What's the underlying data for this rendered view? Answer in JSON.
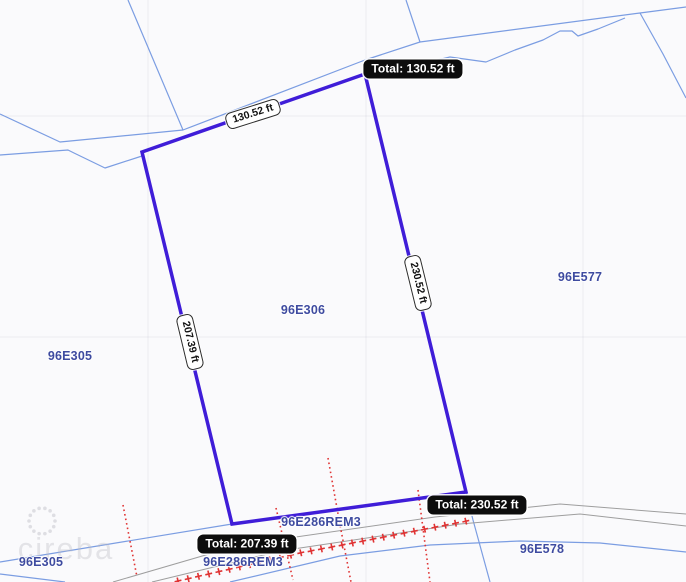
{
  "map": {
    "background": "#fafafc",
    "watermark": {
      "text": "cireba",
      "x": 66,
      "y": 549,
      "color": "rgba(188,188,198,0.38)",
      "logo": {
        "cx": 42,
        "cy": 521,
        "r": 13,
        "dots": 14,
        "dot_r": 1.8,
        "color": "rgba(188,188,198,0.45)"
      }
    },
    "section_lines": {
      "color": "rgba(120,120,150,0.10)",
      "vertical_x": [
        148,
        366,
        583
      ],
      "horizontal_y": [
        116,
        337
      ]
    },
    "boundaries": {
      "color": "#7b9de2",
      "width": 1.2,
      "polylines": [
        [
          [
            0,
            114
          ],
          [
            60,
            142
          ],
          [
            183,
            130
          ],
          [
            365,
            60
          ],
          [
            420,
            42
          ],
          [
            640,
            13
          ],
          [
            686,
            7
          ]
        ],
        [
          [
            128,
            0
          ],
          [
            183,
            130
          ]
        ],
        [
          [
            406,
            0
          ],
          [
            420,
            42
          ]
        ],
        [
          [
            640,
            13
          ],
          [
            663,
            54
          ],
          [
            686,
            98
          ]
        ],
        [
          [
            365,
            63
          ],
          [
            420,
            64
          ],
          [
            450,
            57
          ],
          [
            486,
            62
          ],
          [
            515,
            50
          ],
          [
            543,
            40
          ],
          [
            560,
            31
          ],
          [
            572,
            31
          ],
          [
            578,
            36
          ],
          [
            598,
            29
          ],
          [
            625,
            18
          ]
        ],
        [
          [
            0,
            155
          ],
          [
            68,
            150
          ],
          [
            74,
            153
          ],
          [
            105,
            168
          ],
          [
            142,
            156
          ]
        ],
        [
          [
            0,
            562
          ],
          [
            232,
            524
          ]
        ],
        [
          [
            466,
            492
          ],
          [
            473,
            520
          ],
          [
            490,
            582
          ]
        ],
        [
          [
            0,
            574
          ],
          [
            65,
            582
          ]
        ],
        [
          [
            230,
            582
          ],
          [
            340,
            556
          ],
          [
            430,
            545
          ],
          [
            520,
            541
          ],
          [
            600,
            543
          ],
          [
            686,
            552
          ]
        ]
      ]
    },
    "roads": {
      "color": "#9e9e9e",
      "width": 1,
      "polylines": [
        [
          [
            113,
            582
          ],
          [
            240,
            545
          ],
          [
            435,
            517
          ],
          [
            560,
            504
          ],
          [
            686,
            514
          ]
        ],
        [
          [
            152,
            582
          ],
          [
            280,
            551
          ],
          [
            460,
            524
          ],
          [
            580,
            514
          ],
          [
            686,
            526
          ]
        ]
      ]
    },
    "railroad": {
      "color": "#e03434",
      "polyline": [
        [
          178,
          581
        ],
        [
          300,
          553
        ],
        [
          400,
          534
        ],
        [
          467,
          521
        ]
      ],
      "spacing": 10.5,
      "size": 7,
      "tilt_deg": -13,
      "stroke_width": 1.6
    },
    "easements": {
      "color": "#e03434",
      "dash": "1.6 3",
      "width": 1.6,
      "polylines": [
        [
          [
            123,
            505
          ],
          [
            137,
            577
          ]
        ],
        [
          [
            276,
            508
          ],
          [
            293,
            580
          ]
        ],
        [
          [
            328,
            458
          ],
          [
            340,
            525
          ],
          [
            351,
            582
          ]
        ],
        [
          [
            418,
            490
          ],
          [
            430,
            582
          ]
        ]
      ]
    },
    "parcel_labels": {
      "color": "#3e4ba0",
      "items": [
        {
          "text": "96E306",
          "x": 303,
          "y": 310
        },
        {
          "text": "96E577",
          "x": 580,
          "y": 277
        },
        {
          "text": "96E305",
          "x": 70,
          "y": 356
        },
        {
          "text": "96E305",
          "x": 41,
          "y": 562
        },
        {
          "text": "96E286REM3",
          "x": 321,
          "y": 522
        },
        {
          "text": "96E286REM3",
          "x": 243,
          "y": 562
        },
        {
          "text": "96E578",
          "x": 542,
          "y": 549
        }
      ]
    },
    "measurement": {
      "stroke": "#3f1dd8",
      "width": 3.5,
      "polygon": [
        [
          142,
          152
        ],
        [
          365,
          74
        ],
        [
          466,
          492
        ],
        [
          232,
          524
        ]
      ],
      "segment_chips": [
        {
          "text": "130.52 ft",
          "x": 253,
          "y": 114,
          "rotate": -17.5
        },
        {
          "text": "230.52 ft",
          "x": 418,
          "y": 283,
          "rotate": 76.2
        },
        {
          "text": "207.39 ft",
          "x": 190,
          "y": 342,
          "rotate": 76.5
        }
      ],
      "total_chips": [
        {
          "text": "Total: 130.52 ft",
          "x": 413,
          "y": 69
        },
        {
          "text": "Total: 230.52 ft",
          "x": 477,
          "y": 505
        },
        {
          "text": "Total: 207.39 ft",
          "x": 247,
          "y": 544
        }
      ]
    }
  }
}
